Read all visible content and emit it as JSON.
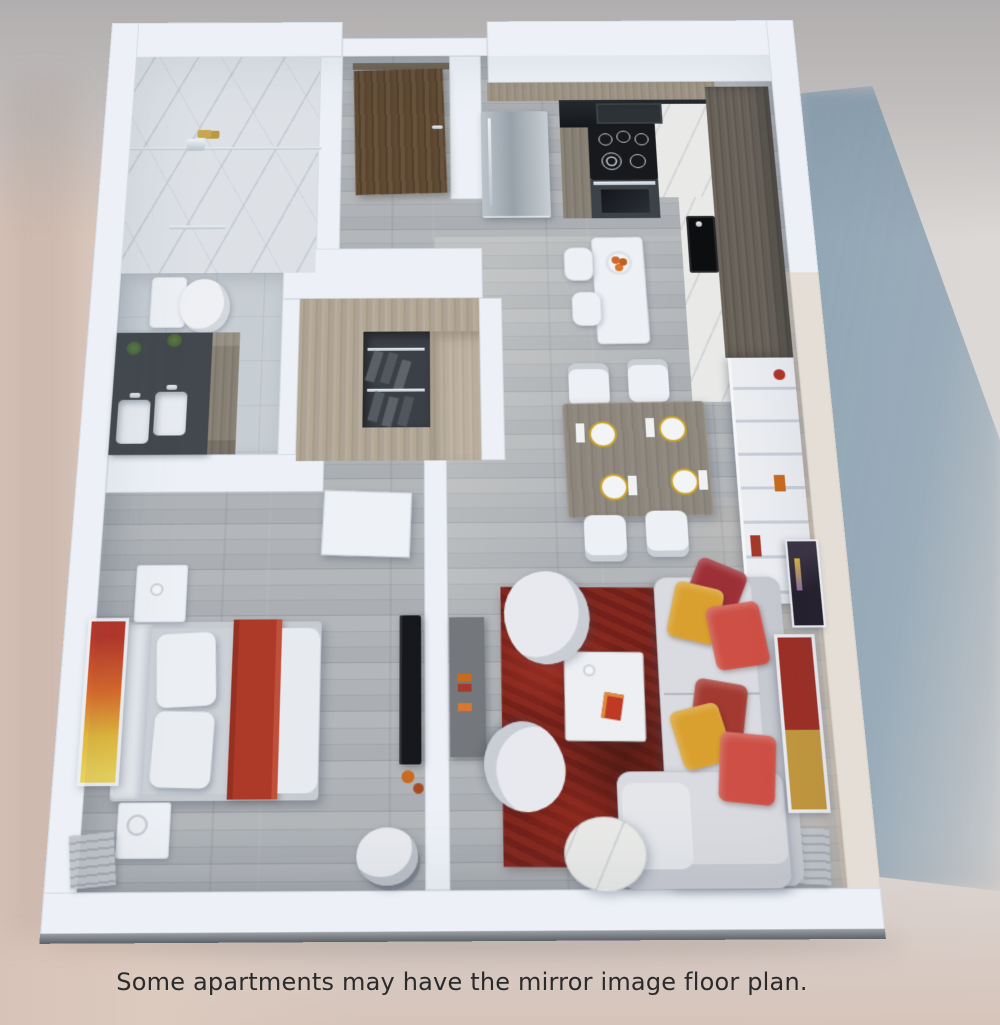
{
  "caption": {
    "text": "Some apartments may have the mirror image floor plan."
  },
  "palette": {
    "walls": "#edf1f7",
    "background_left": "#dccabf",
    "background_top": "#b1aeaf",
    "background_right": "#dcd8d6",
    "shadow_blue": "#6488a2",
    "floor_wood": "#a9aeb2",
    "bathroom_tile": "#c6cdd3",
    "vanity_dark": "#43484e",
    "entry_door_wood": "#5d4833",
    "cabinet_black": "#1d2125",
    "rug_red": "#7c231b",
    "pillow_red": "#cd4f45",
    "pillow_dark_red": "#9c3036",
    "pillow_yellow": "#d9a02f",
    "bed_blanket_red": "#ad3a28",
    "marble": "#e9eae8"
  },
  "scene": {
    "type": "3d-rendered floor plan, top view",
    "rooms": [
      "bathroom",
      "entry",
      "kitchen",
      "walk-in closet",
      "dining area",
      "living room",
      "bedroom"
    ]
  }
}
